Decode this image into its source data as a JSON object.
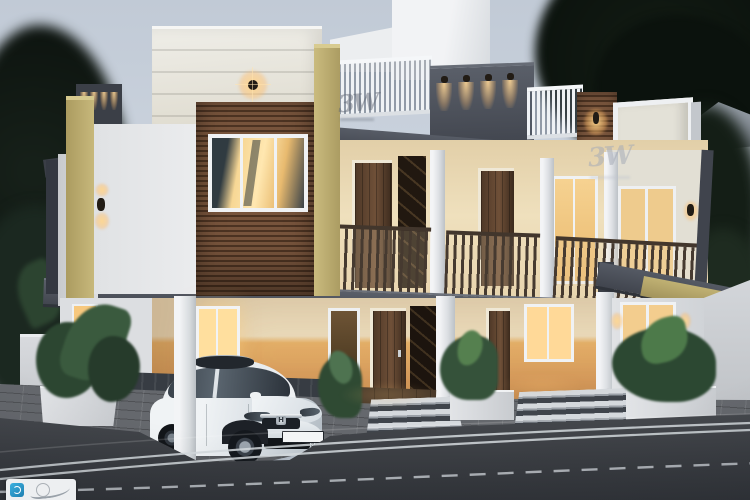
{
  "scene": {
    "title": "Modern two-storey duplex house - dusk 3D exterior render"
  },
  "watermarks": {
    "glyph": "3W"
  },
  "corner_logo": {
    "name": "studio-logo",
    "note": "partially cropped white box with blue icon and gray swoosh"
  },
  "car": {
    "body": "white sedan",
    "brand_badge_letter": "H",
    "license_plate": "KL 44 0862"
  },
  "palette": {
    "sky_top": "#c3ccd7",
    "sky_horizon": "#ccd4de",
    "foliage_dark": "#11190f",
    "wall_white": "#e8e9eb",
    "accent_khaki": "#c0b173",
    "fascia_gray": "#4a4e57",
    "wood_slat_brown": "#6b4c38",
    "window_glow": "#f6cd8a",
    "ground_wall_ochre": "#d89e5e",
    "road_asphalt": "#3e4146",
    "road_marking_white": "#d4d9dd"
  }
}
